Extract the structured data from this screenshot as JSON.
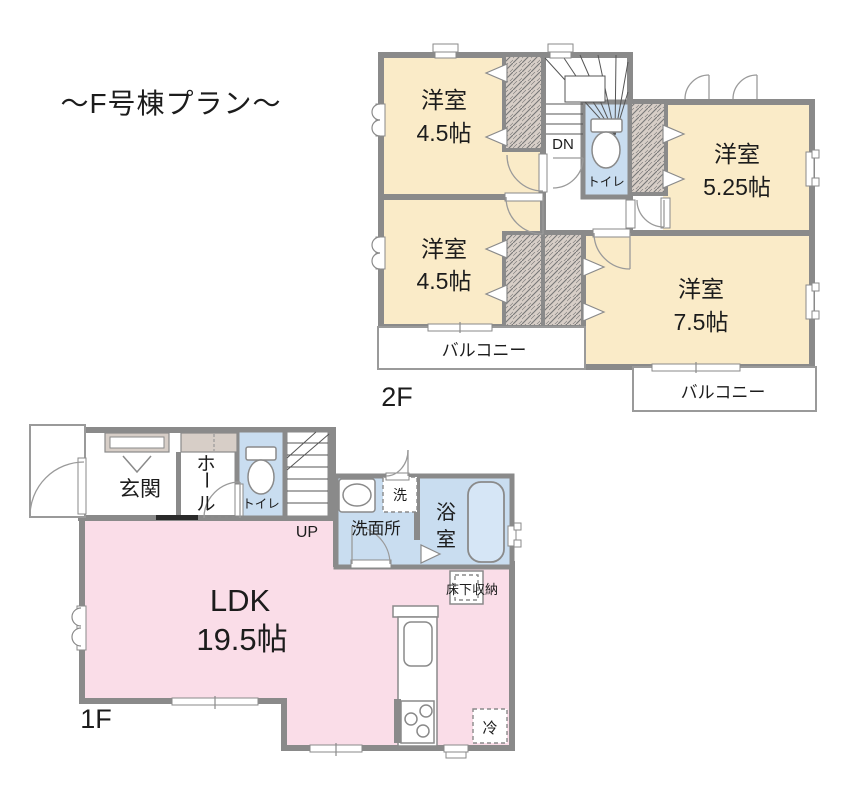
{
  "title": "～F号棟プラン～",
  "colors": {
    "wall": "#8a8a8a",
    "cream": "#faebc8",
    "blue": "#c9ddf0",
    "pink": "#fadde8",
    "beige": "#d7cec7"
  },
  "f2": {
    "label": "2F",
    "rooms": [
      {
        "label": "洋室",
        "size": "4.5帖"
      },
      {
        "label": "洋室",
        "size": "4.5帖"
      },
      {
        "label": "洋室",
        "size": "5.25帖"
      },
      {
        "label": "洋室",
        "size": "7.5帖"
      }
    ],
    "toilet": "トイレ",
    "stairs": "DN",
    "balconies": [
      "バルコニー",
      "バルコニー"
    ]
  },
  "f1": {
    "label": "1F",
    "entrance": "玄関",
    "hall_chars": [
      "ホ",
      "ー",
      "ル"
    ],
    "toilet": "トイレ",
    "stairs": "UP",
    "washroom": "洗面所",
    "washer": "洗",
    "bath_chars": [
      "浴",
      "室"
    ],
    "ldk": "LDK",
    "ldk_size": "19.5帖",
    "floor_storage": "床下収納",
    "fridge": "冷"
  }
}
